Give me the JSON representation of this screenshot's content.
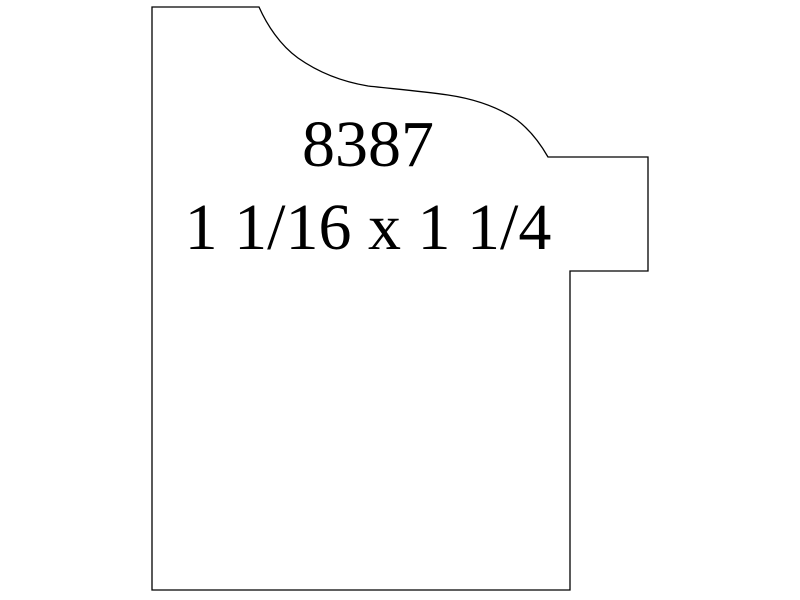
{
  "page": {
    "background_color": "#ffffff"
  },
  "drawing": {
    "type": "moulding-profile-cross-section",
    "profile_number": "8387",
    "dimensions_label": "1 1/16 x 1 1/4",
    "line_color": "#000000",
    "text_color": "#000000",
    "outline_path": "M152,7 L259,7 C267,25 280,45 298,58 C315,70 338,81 368,86 C395,89 420,91 448,95 C475,99 498,107 517,120 C530,130 540,143 548,157 L648,157 L648,271 L570,271 L570,590 L152,590 Z"
  }
}
